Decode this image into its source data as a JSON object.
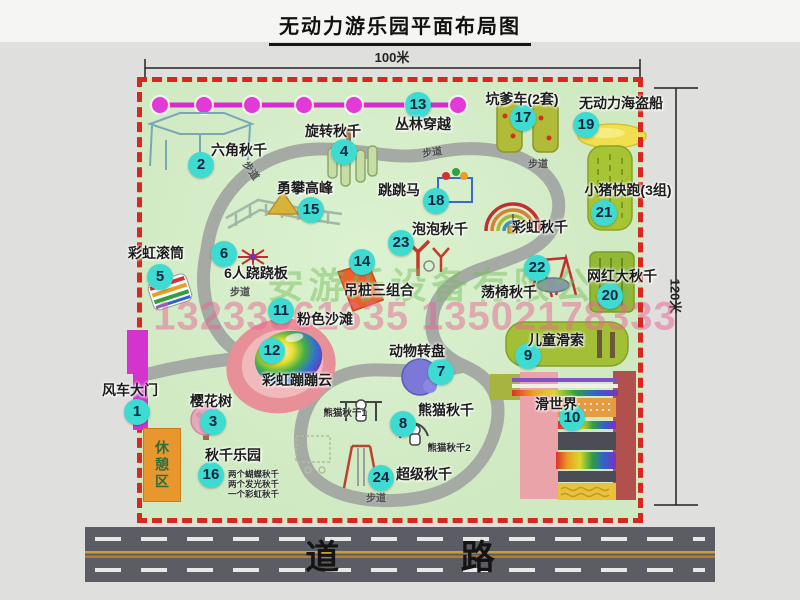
{
  "title": "无动力游乐园平面布局图",
  "dimensions": {
    "width": "100米",
    "height": "120米"
  },
  "watermark": {
    "company": "安游乐设备有限公司",
    "phone": "13233861635 13502178333"
  },
  "road": {
    "label": "道 路"
  },
  "colors": {
    "border_dash": "#d6281e",
    "badge": "#3edbd2",
    "park_fill": "#cfe9c2",
    "zipline": "#d62ccc",
    "road_asphalt": "#5c5c64",
    "rest_area": "#e8962e"
  },
  "park": {
    "rest_area_label": "休憩区",
    "walkway_labels": [
      {
        "text": "步道",
        "x": 252,
        "y": 170,
        "rot": 55
      },
      {
        "text": "步道",
        "x": 432,
        "y": 151,
        "rot": -8
      },
      {
        "text": "步道",
        "x": 538,
        "y": 163,
        "rot": 0
      },
      {
        "text": "步道",
        "x": 240,
        "y": 291,
        "rot": 0
      },
      {
        "text": "步道",
        "x": 376,
        "y": 497,
        "rot": 0
      }
    ],
    "attractions": [
      {
        "num": "1",
        "name": "风车大门",
        "bx": 137,
        "by": 412,
        "lx": 130,
        "ly": 390
      },
      {
        "num": "2",
        "name": "六角秋千",
        "bx": 201,
        "by": 165,
        "lx": 239,
        "ly": 150
      },
      {
        "num": "3",
        "name": "樱花树",
        "bx": 213,
        "by": 422,
        "lx": 211,
        "ly": 401
      },
      {
        "num": "4",
        "name": "旋转秋千",
        "bx": 344,
        "by": 152,
        "lx": 333,
        "ly": 131
      },
      {
        "num": "5",
        "name": "彩虹滚筒",
        "bx": 160,
        "by": 277,
        "lx": 156,
        "ly": 253
      },
      {
        "num": "6",
        "name": "6人跷跷板",
        "bx": 224,
        "by": 254,
        "lx": 256,
        "ly": 273
      },
      {
        "num": "7",
        "name": "动物转盘",
        "bx": 441,
        "by": 372,
        "lx": 417,
        "ly": 351
      },
      {
        "num": "8",
        "name": "熊猫秋千",
        "bx": 403,
        "by": 424,
        "lx": 446,
        "ly": 410
      },
      {
        "num": "9",
        "name": "儿童滑索",
        "bx": 528,
        "by": 356,
        "lx": 556,
        "ly": 340
      },
      {
        "num": "10",
        "name": "滑世界",
        "bx": 572,
        "by": 418,
        "lx": 556,
        "ly": 404
      },
      {
        "num": "11",
        "name": "粉色沙滩",
        "bx": 281,
        "by": 311,
        "lx": 325,
        "ly": 319
      },
      {
        "num": "12",
        "name": "彩虹蹦蹦云",
        "bx": 272,
        "by": 351,
        "lx": 297,
        "ly": 380
      },
      {
        "num": "13",
        "name": "丛林穿越",
        "bx": 418,
        "by": 105,
        "lx": 423,
        "ly": 124
      },
      {
        "num": "14",
        "name": "吊桩三组合",
        "bx": 362,
        "by": 262,
        "lx": 379,
        "ly": 290
      },
      {
        "num": "15",
        "name": "勇攀高峰",
        "bx": 311,
        "by": 210,
        "lx": 305,
        "ly": 188
      },
      {
        "num": "16",
        "name": "秋千乐园",
        "bx": 211,
        "by": 475,
        "lx": 233,
        "ly": 455,
        "notes": [
          "两个蝴蝶秋千",
          "两个发光秋千",
          "一个彩虹秋千"
        ],
        "nx": 228,
        "ny": 474,
        "nstep": 10
      },
      {
        "num": "17",
        "name": "坑爹车(2套)",
        "bx": 523,
        "by": 118,
        "lx": 522,
        "ly": 99
      },
      {
        "num": "18",
        "name": "跳跳马",
        "bx": 436,
        "by": 201,
        "lx": 399,
        "ly": 190
      },
      {
        "num": "19",
        "name": "无动力海盗船",
        "bx": 586,
        "by": 125,
        "lx": 621,
        "ly": 103
      },
      {
        "num": "20",
        "name": "网红大秋千",
        "bx": 610,
        "by": 296,
        "lx": 622,
        "ly": 276
      },
      {
        "num": "21",
        "name": "小猪快跑(3组)",
        "bx": 604,
        "by": 213,
        "lx": 628,
        "ly": 190
      },
      {
        "num": "22",
        "name": "荡椅秋千",
        "bx": 537,
        "by": 268,
        "lx": 509,
        "ly": 292
      },
      {
        "num": "23",
        "name": "泡泡秋千",
        "bx": 401,
        "by": 243,
        "lx": 440,
        "ly": 229
      },
      {
        "num": "24",
        "name": "超级秋千",
        "bx": 381,
        "by": 478,
        "lx": 424,
        "ly": 474
      },
      {
        "num": "",
        "name": "彩虹秋千",
        "lx": 540,
        "ly": 227
      }
    ],
    "small_labels": [
      {
        "text": "熊猫秋千1",
        "x": 345,
        "y": 412
      },
      {
        "text": "熊猫秋千2",
        "x": 449,
        "y": 447
      }
    ]
  }
}
